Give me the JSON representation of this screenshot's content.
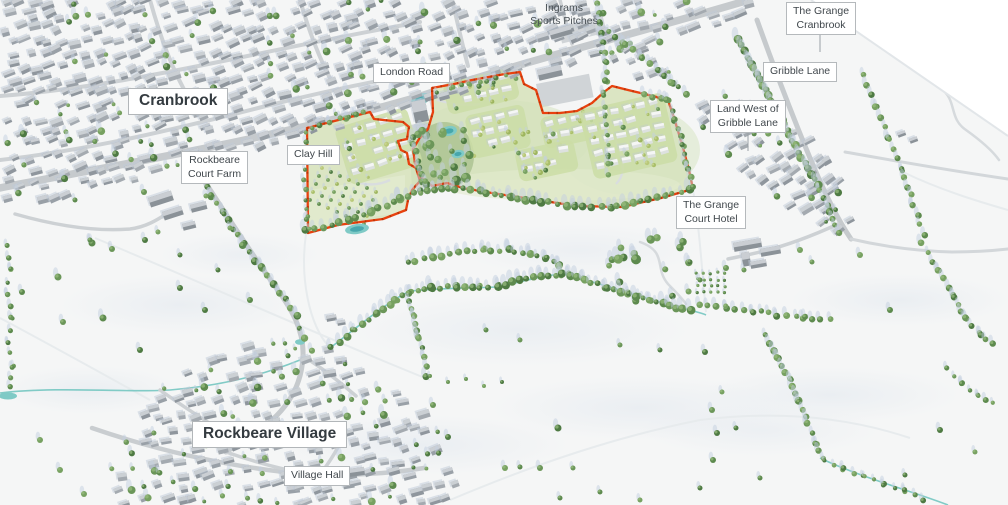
{
  "map": {
    "labels": {
      "cranbrook": "Cranbrook",
      "rockbeare_court_farm": "Rockbeare\nCourt Farm",
      "clay_hill": "Clay Hill",
      "london_road": "London Road",
      "ingrams_sports_pitches": "Ingrams\nSports Pitches",
      "the_grange_cranbrook": "The Grange\nCranbrook",
      "gribble_lane": "Gribble Lane",
      "land_west_of_gribble_lane": "Land West of\nGribble Lane",
      "the_grange_court_hotel": "The Grange\nCourt Hotel",
      "rockbeare_village": "Rockbeare Village",
      "village_hall": "Village Hall"
    }
  },
  "colors": {
    "site_boundary_red": "#e8410e",
    "site_green": "#dbe5c3",
    "water_teal": "#74c7c1",
    "road_gray": "#c6cacd",
    "building_gray": "#9aa1a8",
    "tree_green": "#5d8a4e",
    "label_text": "#40474c",
    "label_border": "#b5b9bc",
    "label_background": "#ffffff"
  }
}
